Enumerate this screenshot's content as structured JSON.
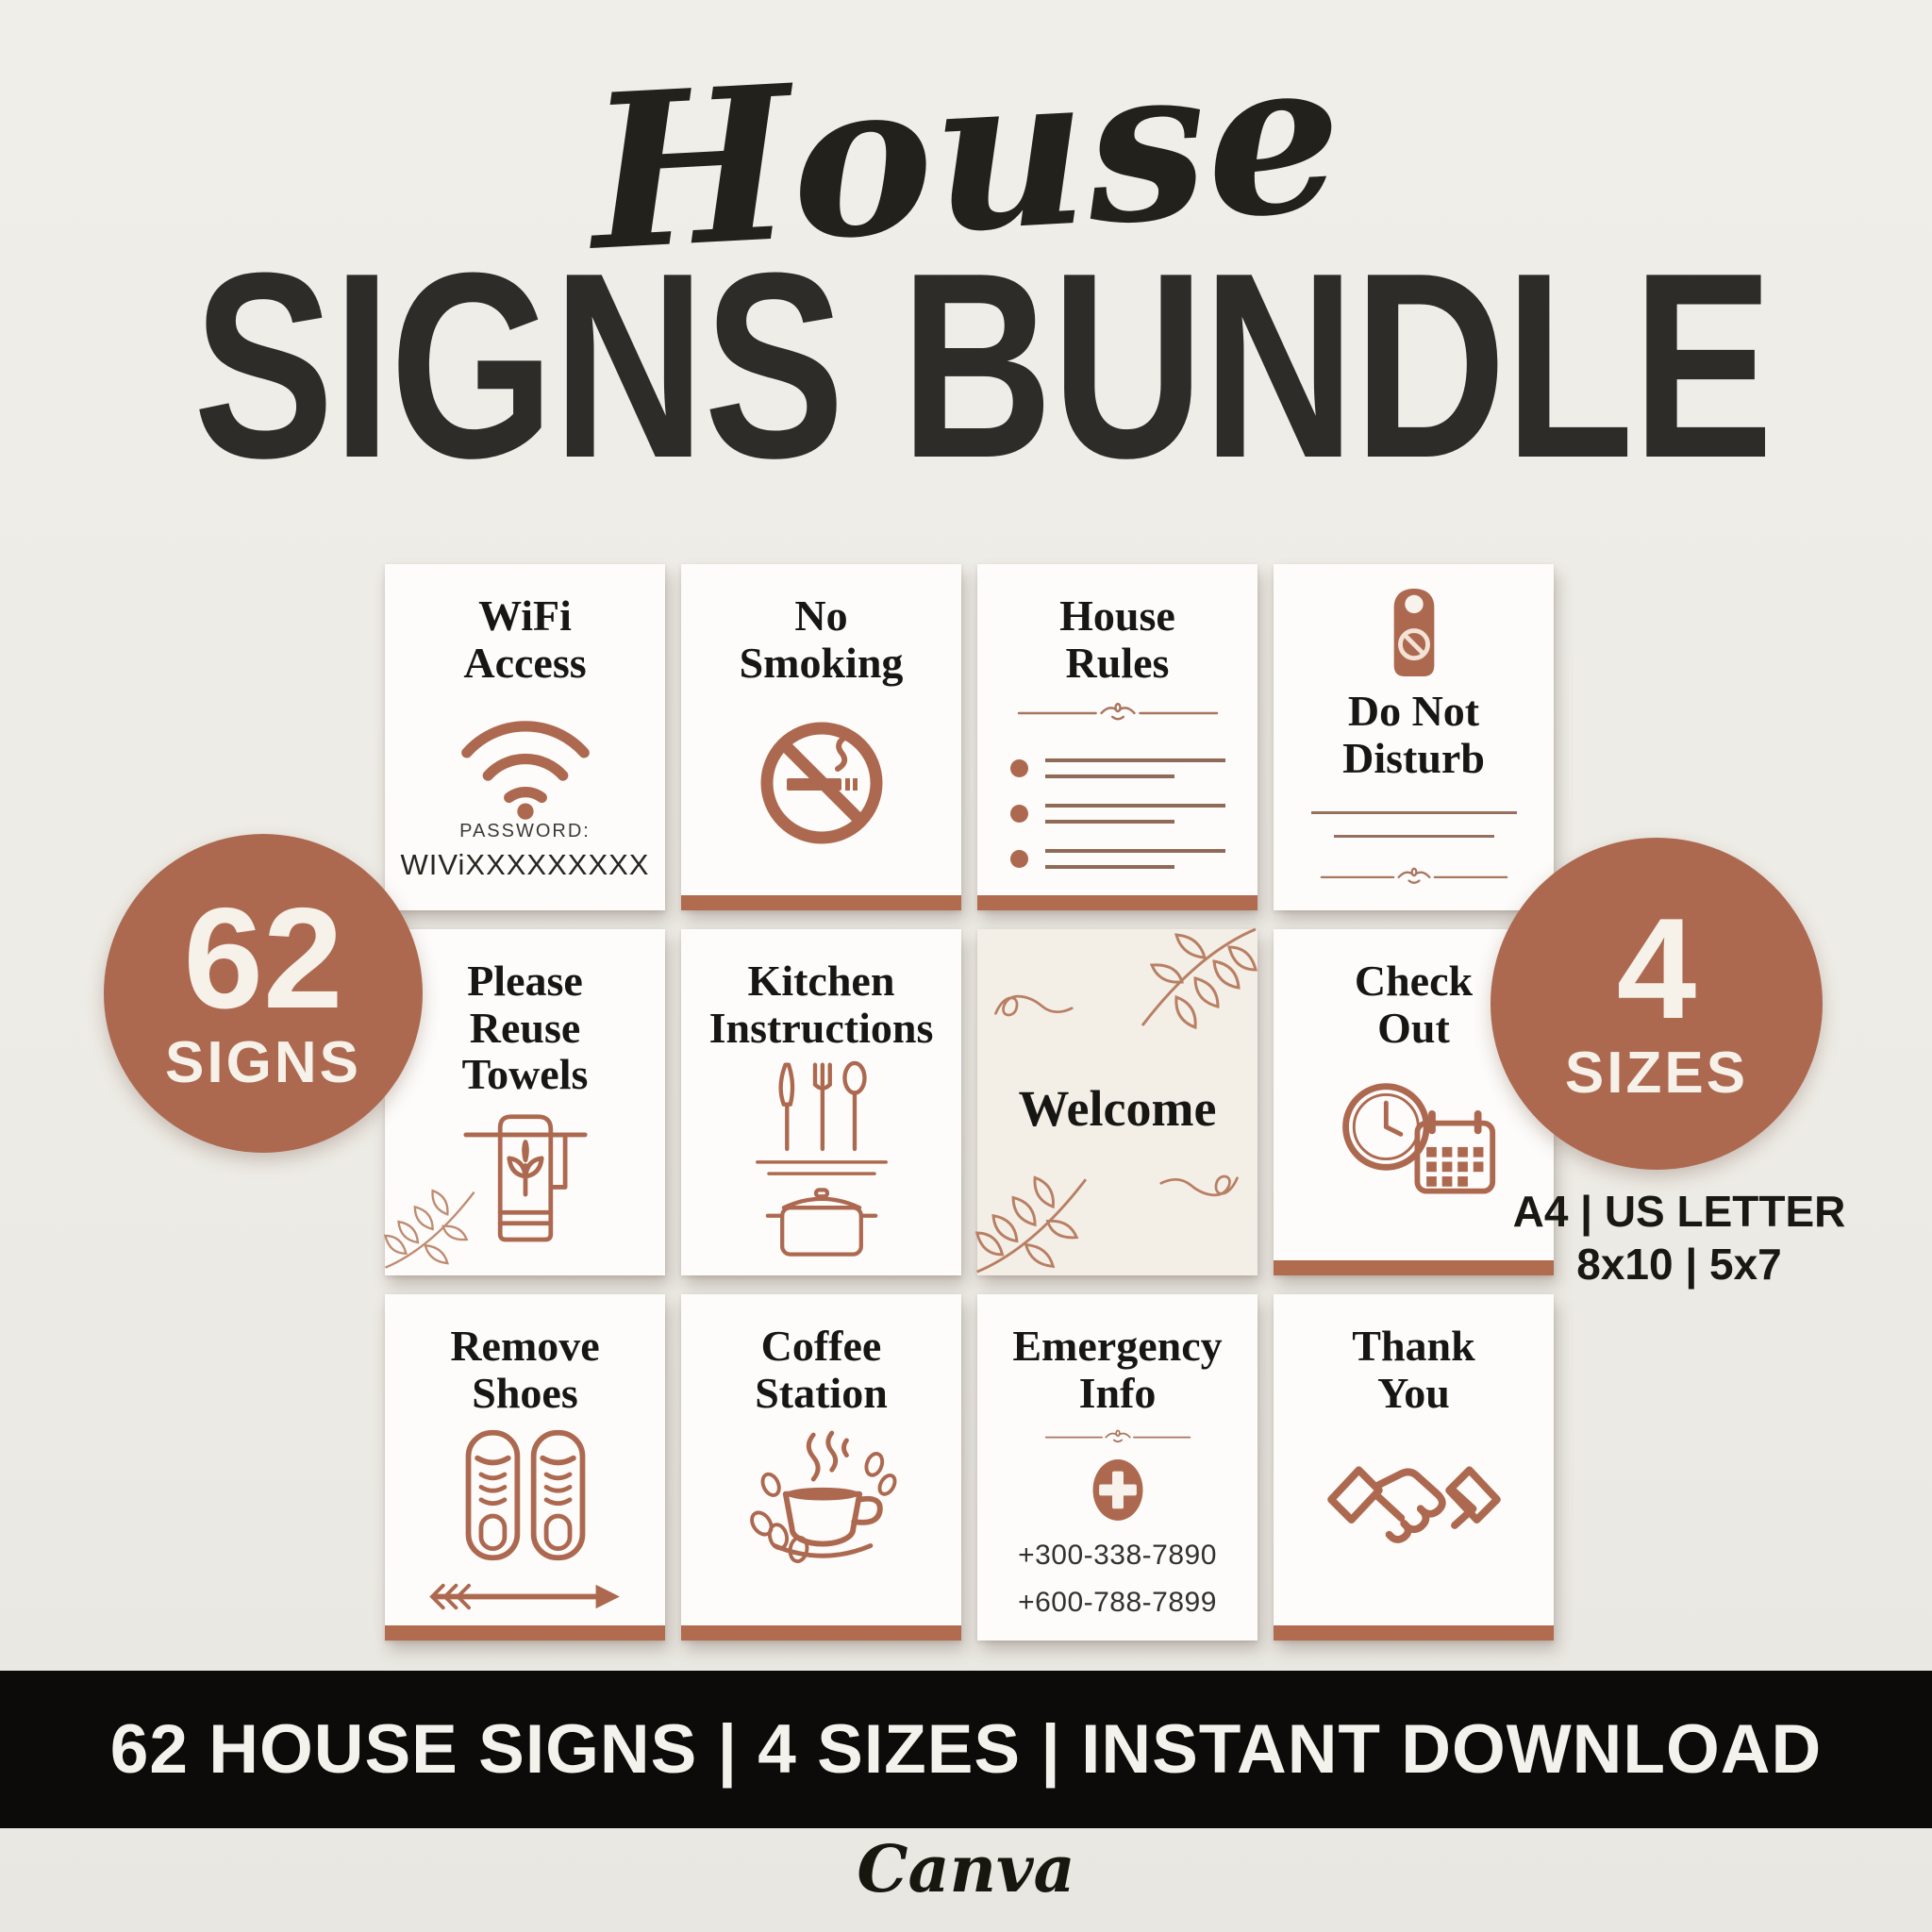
{
  "poster": {
    "background_color": "#efede7",
    "accent_color": "#ad6950",
    "heading_color": "#2d2c29",
    "footer_bar_color": "#0c0b09"
  },
  "header": {
    "script_title": "House",
    "main_title": "SIGNS BUNDLE"
  },
  "badge_left": {
    "number": "62",
    "label": "SIGNS"
  },
  "badge_right": {
    "number": "4",
    "label": "SIZES"
  },
  "sizes_note": {
    "line1": "A4 | US LETTER",
    "line2": "8x10 | 5x7"
  },
  "cards": [
    {
      "title": "WiFi\nAccess",
      "icon": "wifi-icon",
      "password_label": "PASSWORD:",
      "password_value": "WIViXXXXXXXXX"
    },
    {
      "title": "No\nSmoking",
      "icon": "no-smoking-icon",
      "accent_bar": true
    },
    {
      "title": "House\nRules",
      "icon": "bullet-list-with-flourish-divider",
      "accent_bar": true
    },
    {
      "title": "Do Not\nDisturb",
      "icon": "door-hanger-icon"
    },
    {
      "title": "Please\nReuse\nTowels",
      "icon": "towel-with-leaf-icon"
    },
    {
      "title": "Kitchen\nInstructions",
      "icon": "cutlery-and-pot-icon"
    },
    {
      "title": "Welcome",
      "icon": "leaf-branch-decoration"
    },
    {
      "title": "Check\nOut",
      "icon": "clock-calendar-icon",
      "accent_bar": true
    },
    {
      "title": "Remove\nShoes",
      "icon": "sneakers-and-arrow-icon",
      "accent_bar": true
    },
    {
      "title": "Coffee\nStation",
      "icon": "coffee-cup-icon",
      "accent_bar": true
    },
    {
      "title": "Emergency\nInfo",
      "icon": "medical-cross-icon",
      "phone1": "+300-338-7890",
      "phone2": "+600-788-7899"
    },
    {
      "title": "Thank\nYou",
      "icon": "handshake-icon",
      "accent_bar": true
    }
  ],
  "footer": {
    "bar_text": "62 HOUSE SIGNS | 4 SIZES | INSTANT DOWNLOAD",
    "brand": "Canva"
  }
}
